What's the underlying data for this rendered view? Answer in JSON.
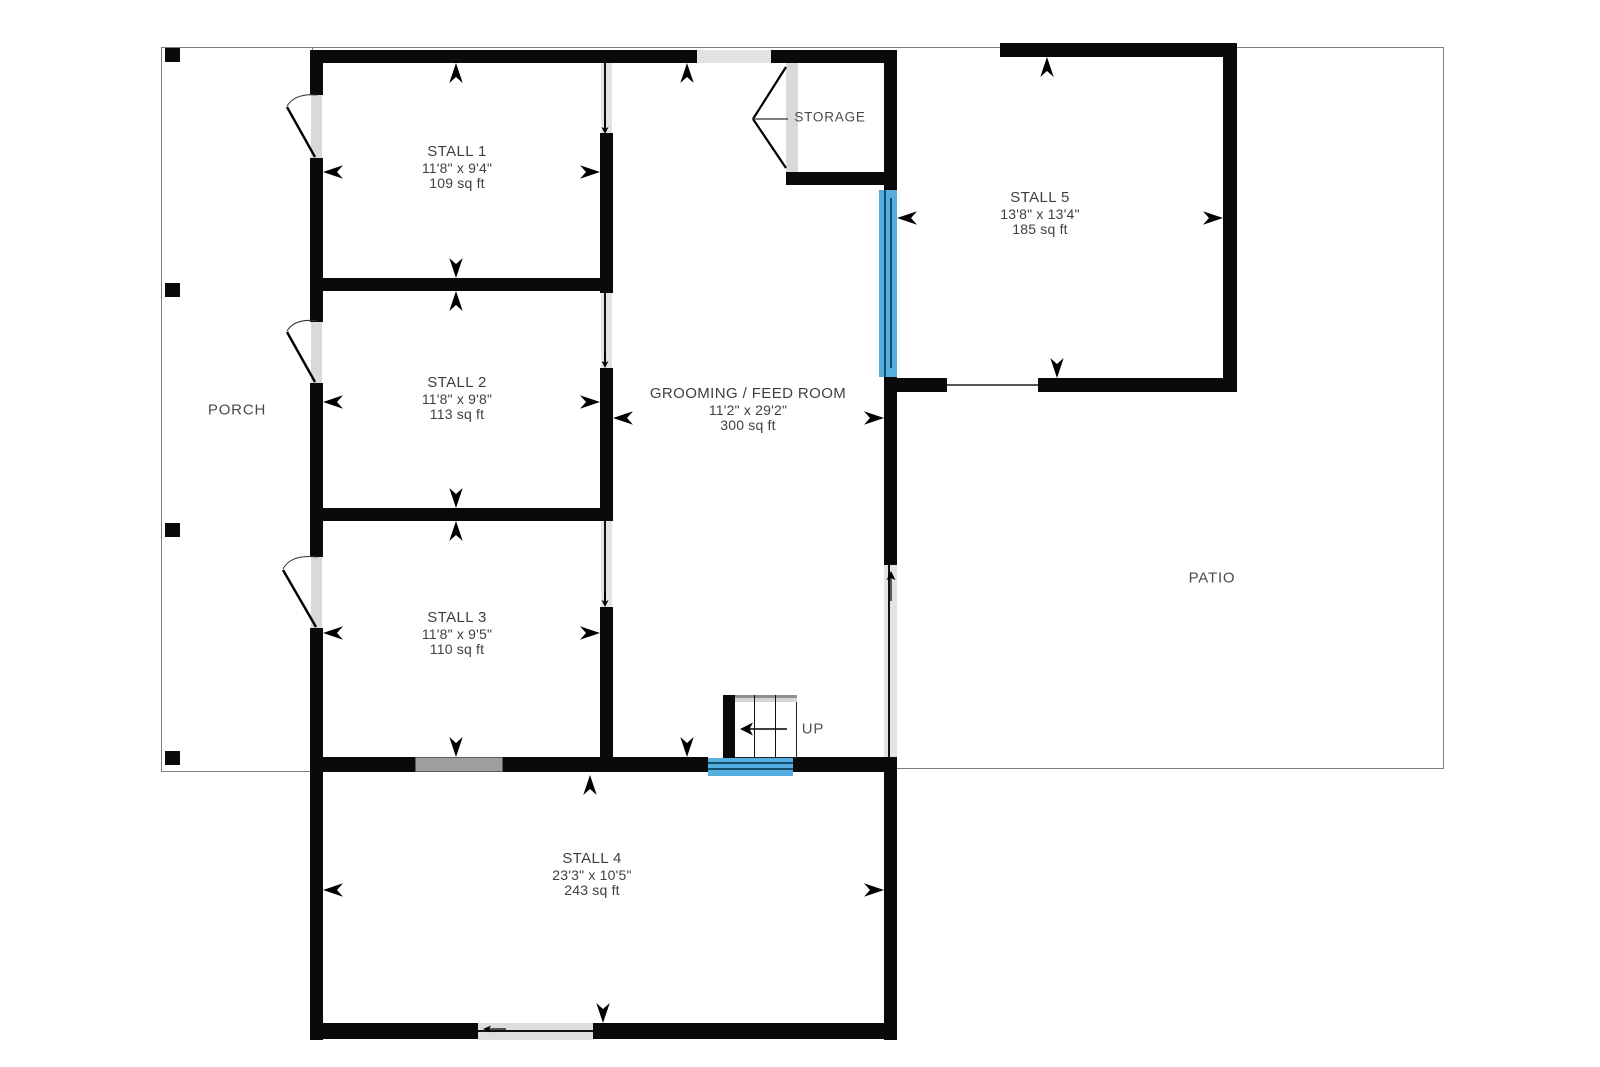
{
  "plan": {
    "title": "Barn floor plan",
    "rooms": [
      {
        "id": "stall1",
        "name": "STALL 1",
        "dims": "11'8\" x 9'4\"",
        "area": "109 sq ft"
      },
      {
        "id": "stall2",
        "name": "STALL 2",
        "dims": "11'8\" x 9'8\"",
        "area": "113 sq ft"
      },
      {
        "id": "stall3",
        "name": "STALL 3",
        "dims": "11'8\" x 9'5\"",
        "area": "110 sq ft"
      },
      {
        "id": "stall4",
        "name": "STALL 4",
        "dims": "23'3\" x 10'5\"",
        "area": "243 sq ft"
      },
      {
        "id": "stall5",
        "name": "STALL 5",
        "dims": "13'8\" x 13'4\"",
        "area": "185 sq ft"
      },
      {
        "id": "grooming",
        "name": "GROOMING / FEED ROOM",
        "dims": "11'2\" x 29'2\"",
        "area": "300 sq ft"
      }
    ],
    "zones": {
      "porch": "PORCH",
      "patio": "PATIO",
      "storage": "STORAGE",
      "stairs_label": "UP"
    },
    "colors": {
      "wall": "#0a0a0a",
      "sliding_door_blue": "#55aedd",
      "sliding_door_gray": "#9e9e9e",
      "opening_gray": "#e3e3e3",
      "thin_line": "#7d7d7d",
      "label_text": "#3f3f3f"
    }
  }
}
